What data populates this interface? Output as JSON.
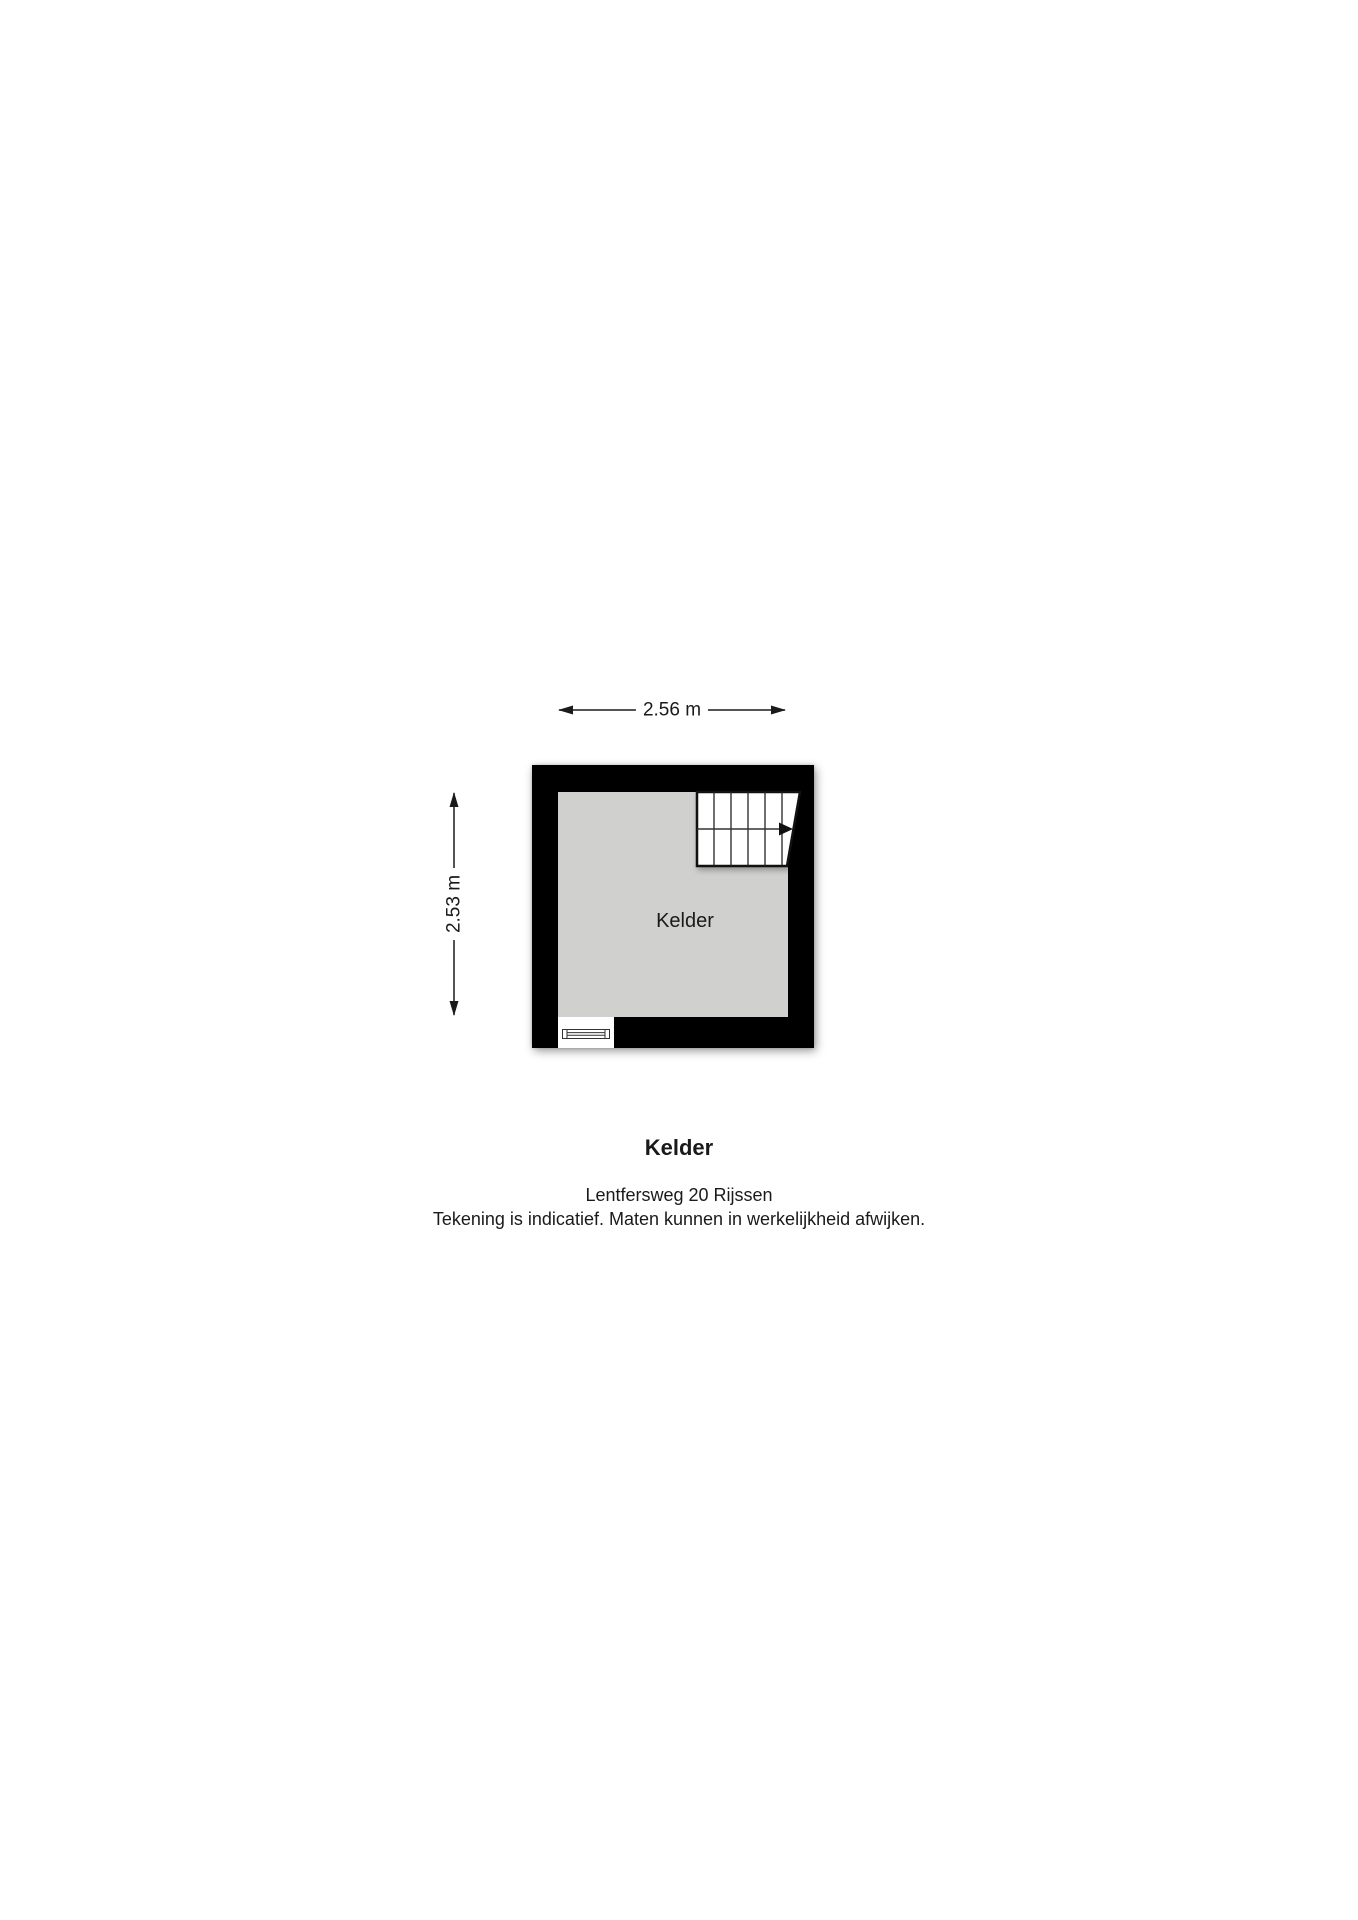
{
  "dimensions": {
    "width_label": "2.56 m",
    "height_label": "2.53 m"
  },
  "plan": {
    "room_label": "Kelder",
    "features": [
      "stairs-symbol",
      "window-symbol"
    ],
    "colors": {
      "wall": "#000000",
      "floor": "#d0d0cf",
      "symbol_lines": "#1a1a1a",
      "background": "#ffffff"
    }
  },
  "caption": {
    "title": "Kelder",
    "address": "Lentfersweg 20 Rijssen",
    "disclaimer": "Tekening is indicatief. Maten kunnen in werkelijkheid afwijken."
  }
}
